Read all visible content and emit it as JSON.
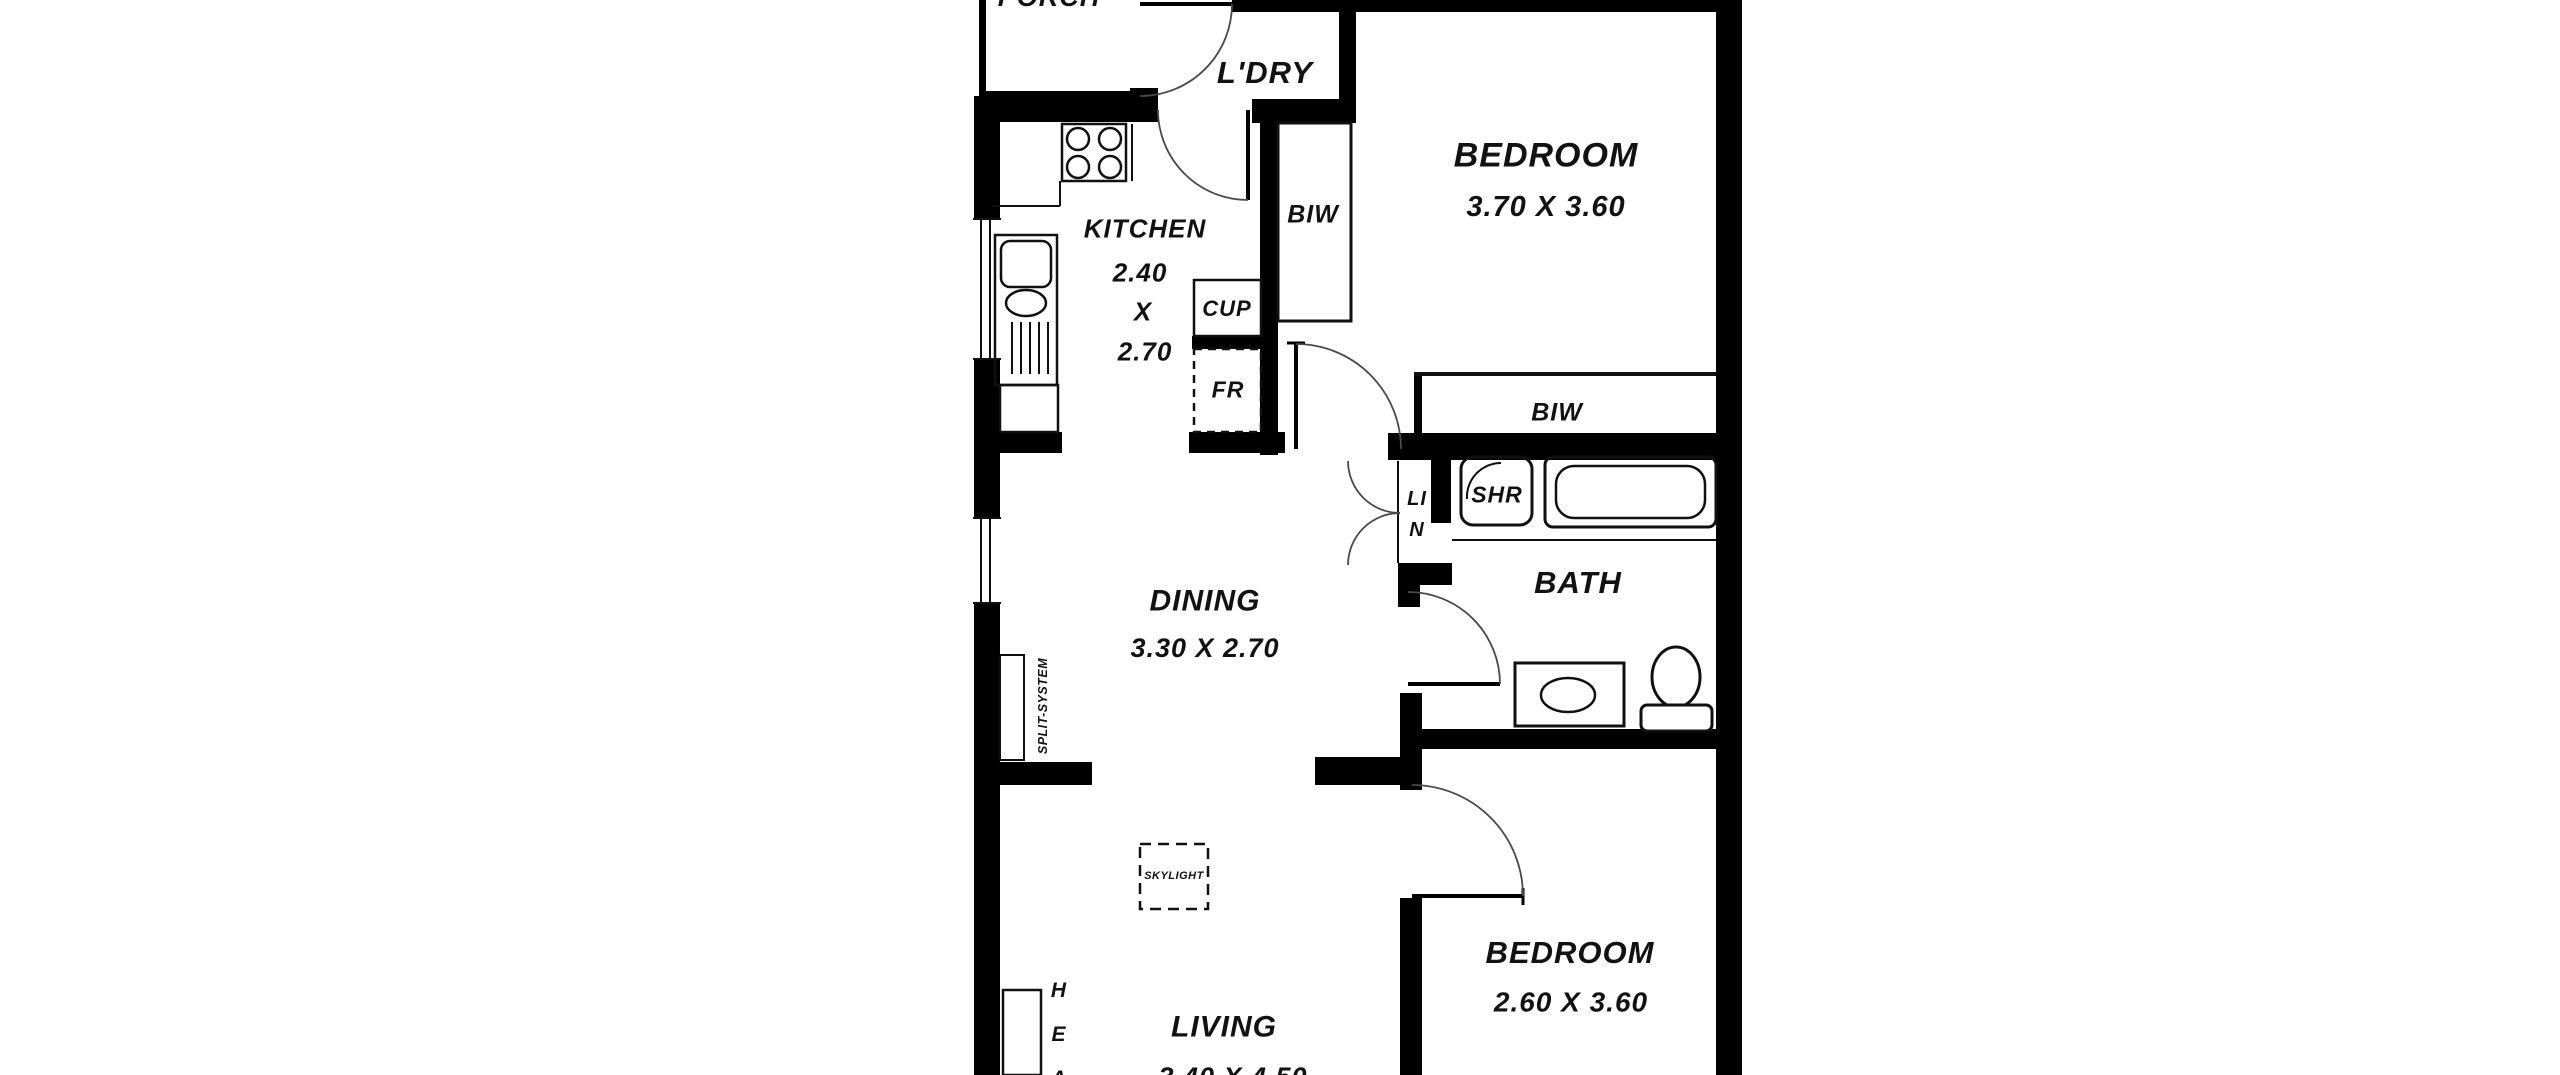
{
  "plan": {
    "rooms": {
      "porch": {
        "label": "PORCH"
      },
      "laundry": {
        "label": "L'DRY"
      },
      "bedroom1": {
        "label": "BEDROOM",
        "dims": "3.70 X 3.60"
      },
      "kitchen": {
        "label": "KITCHEN",
        "dims_line1": "2.40",
        "dims_line2": "X",
        "dims_line3": "2.70"
      },
      "dining": {
        "label": "DINING",
        "dims": "3.30 X 2.70"
      },
      "bath": {
        "label": "BATH"
      },
      "living": {
        "label": "LIVING",
        "dims": "3.40 X 4.50"
      },
      "bedroom2": {
        "label": "BEDROOM",
        "dims": "2.60 X 3.60"
      }
    },
    "storage": {
      "biw_bedroom1": {
        "label": "BIW"
      },
      "biw_hall": {
        "label": "BIW"
      },
      "cupboard": {
        "label": "CUP"
      },
      "fridge": {
        "label": "FR"
      },
      "linen": {
        "line1": "LI",
        "line2": "N"
      },
      "shower": {
        "label": "SHR"
      }
    },
    "annotations": {
      "skylight": "SKYLIGHT",
      "split_system": "SPLIT-SYSTEM",
      "heater_partial": "HEA"
    },
    "colors": {
      "wall": "#000000",
      "line": "#101010",
      "door_arc": "#4a4a4a",
      "text": "#121212",
      "background": "#ffffff"
    }
  }
}
